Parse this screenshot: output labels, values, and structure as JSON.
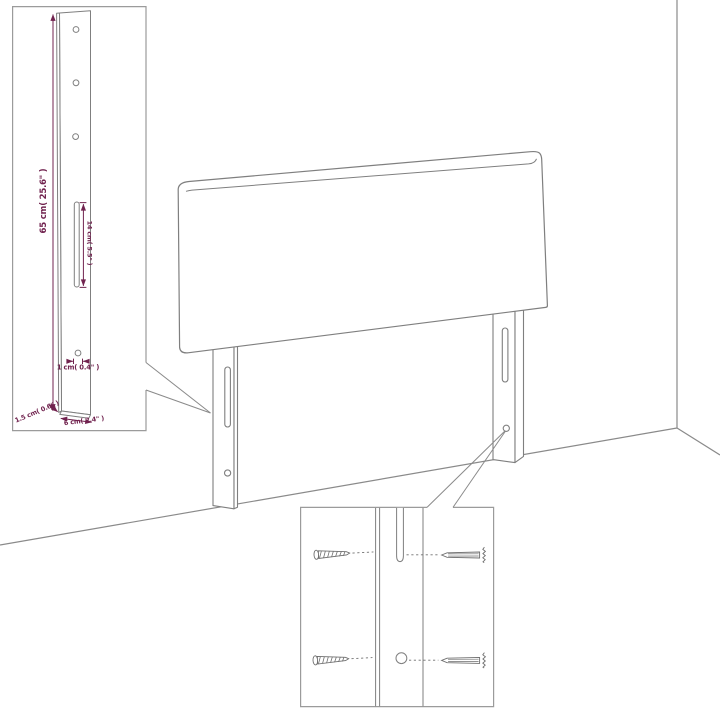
{
  "scene": {
    "background_color": "#ffffff",
    "line_color": "#7f7f7f",
    "inset_border_color": "#9b9b9b",
    "dimension_color": "#71234f"
  },
  "dimension_labels": {
    "leg_height": "65 cm( 25.6\" )",
    "slot_length": "14 cm( 5.5\" )",
    "hole_diameter": "1 cm( 0.4\" )",
    "leg_depth": "1.5 cm( 0.6\" )",
    "leg_width": "6 cm( 2.4\" )"
  }
}
